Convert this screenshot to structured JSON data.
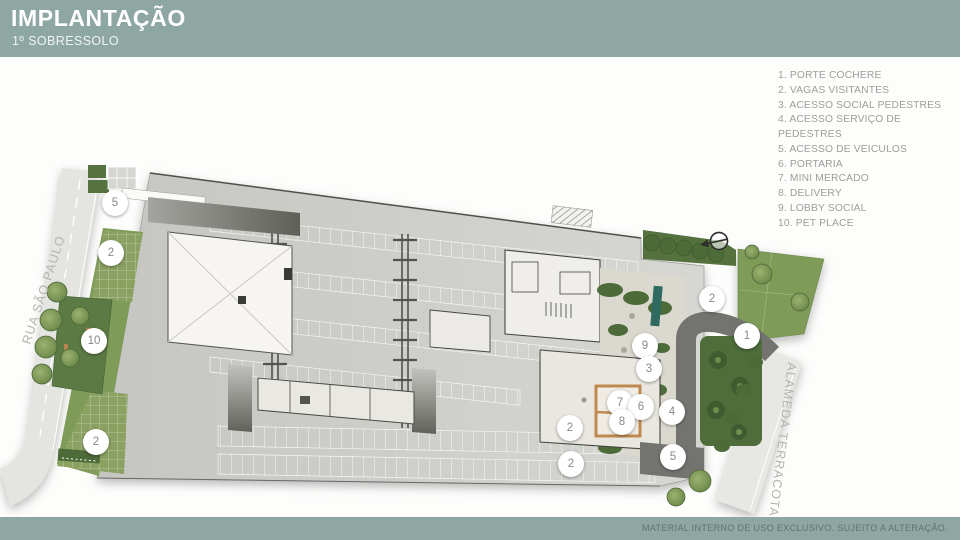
{
  "header": {
    "title": "IMPLANTAÇÃO",
    "subtitle": "1º SOBRESSOLO"
  },
  "legend": {
    "items": [
      {
        "num": "1.",
        "label": "PORTE COCHERE"
      },
      {
        "num": "2.",
        "label": "VAGAS VISITANTES"
      },
      {
        "num": "3.",
        "label": "ACESSO SOCIAL PEDESTRES"
      },
      {
        "num": "4.",
        "label": "ACESSO SERVIÇO DE PEDESTRES"
      },
      {
        "num": "5.",
        "label": "ACESSO DE VEICULOS"
      },
      {
        "num": "6.",
        "label": "PORTARIA"
      },
      {
        "num": "7.",
        "label": "MINI MERCADO"
      },
      {
        "num": "8.",
        "label": "DELIVERY"
      },
      {
        "num": "9.",
        "label": "LOBBY SOCIAL"
      },
      {
        "num": "10.",
        "label": "PET PLACE"
      }
    ]
  },
  "plan": {
    "street_left": "RUA SÃO PAULO",
    "street_right": "ALAMEDA TERRACOTA",
    "north_arrow_icon": "compass-north-arrow",
    "markers": [
      {
        "label": "5",
        "x": 115,
        "y": 203
      },
      {
        "label": "2",
        "x": 111,
        "y": 253
      },
      {
        "label": "10",
        "x": 94,
        "y": 341
      },
      {
        "label": "2",
        "x": 96,
        "y": 442
      },
      {
        "label": "2",
        "x": 712,
        "y": 299
      },
      {
        "label": "1",
        "x": 747,
        "y": 336
      },
      {
        "label": "9",
        "x": 645,
        "y": 346
      },
      {
        "label": "3",
        "x": 649,
        "y": 369
      },
      {
        "label": "7",
        "x": 620,
        "y": 403
      },
      {
        "label": "6",
        "x": 641,
        "y": 407
      },
      {
        "label": "8",
        "x": 622,
        "y": 422
      },
      {
        "label": "4",
        "x": 672,
        "y": 412
      },
      {
        "label": "2",
        "x": 570,
        "y": 428
      },
      {
        "label": "2",
        "x": 571,
        "y": 464
      },
      {
        "label": "5",
        "x": 673,
        "y": 457
      }
    ]
  },
  "footer": {
    "disclaimer": "MATERIAL INTERNO DE USO EXCLUSIVO. SUJEITO A ALTERAÇÃO."
  },
  "colors": {
    "band": "#8fa7a3",
    "deck_gray": "#c9cac5",
    "lawn_green": "#7e9b58",
    "hedge_green": "#4c6b39",
    "planter_teal": "#2f6a60",
    "wood_tan": "#c08a4e"
  }
}
